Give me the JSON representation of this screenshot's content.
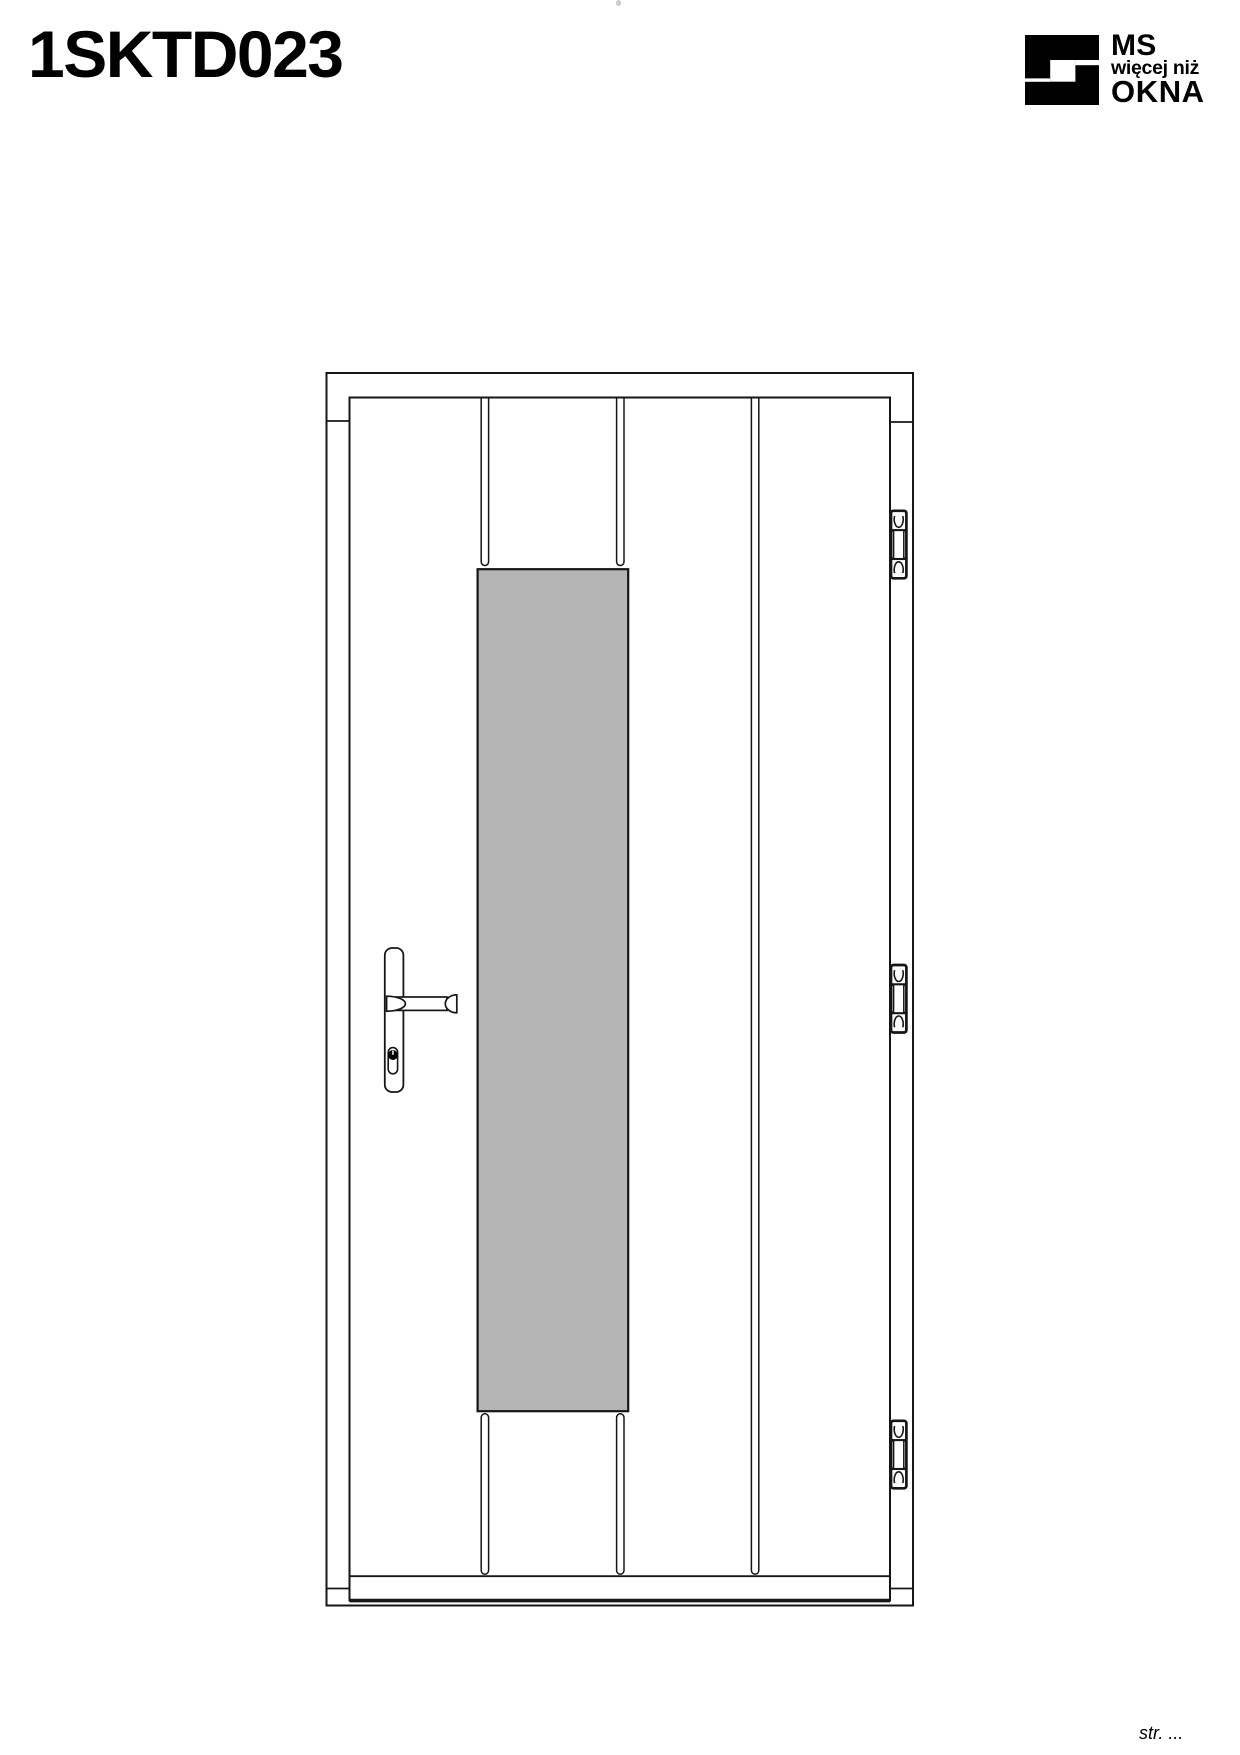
{
  "page": {
    "title": "1SKTD023",
    "stray_mark": " ",
    "footer": {
      "page_label": "str. ..."
    }
  },
  "logo": {
    "line1": "MS",
    "line2": "więcej niż",
    "line3": "OKNA",
    "mark_icon": "ms-okna-logo-mark"
  },
  "drawing": {
    "description": "front elevation of an entry door with vertical panel grooves, tall glass pane, lever handle with cylinder lock, and three hinges on the right side"
  },
  "theme": {
    "ink": "#000000",
    "line": "#161616",
    "glass_fill": "#b4b4b4",
    "paper": "#ffffff"
  }
}
